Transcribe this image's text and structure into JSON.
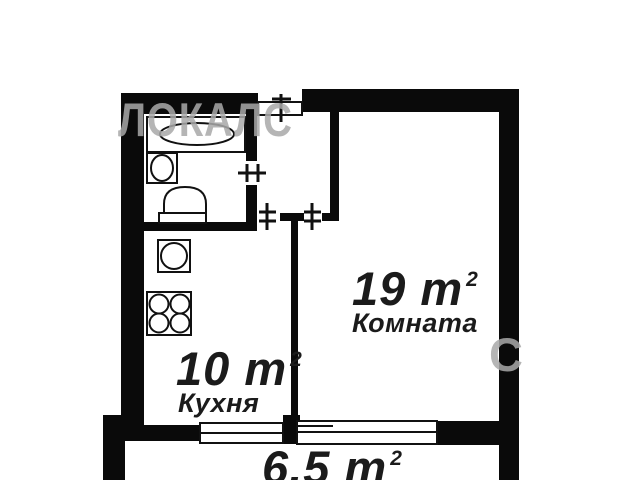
{
  "plan": {
    "rooms": [
      {
        "id": "room",
        "area": "19",
        "unit": "m",
        "area_sup": "2",
        "label": "Комната"
      },
      {
        "id": "kitchen",
        "area": "10",
        "unit": "m",
        "area_sup": "2",
        "label": "Кухня"
      },
      {
        "id": "balcony",
        "area": "6.5",
        "unit": "m",
        "area_sup": "2",
        "label": ""
      }
    ],
    "fixtures": [
      "bathtub",
      "wash-basin",
      "toilet",
      "kitchen-sink",
      "stove-4-burners"
    ],
    "door_openings": [
      "entrance",
      "bathroom",
      "kitchen",
      "room"
    ],
    "windows": [
      "kitchen-window",
      "room-window"
    ],
    "watermark": {
      "brand": "ЛОКАЛС",
      "fragment": "С"
    },
    "colors": {
      "wall": "#0a0a0a",
      "background": "#ffffff",
      "label": "#1b1b1b",
      "watermark": "#a9a9a9"
    }
  }
}
